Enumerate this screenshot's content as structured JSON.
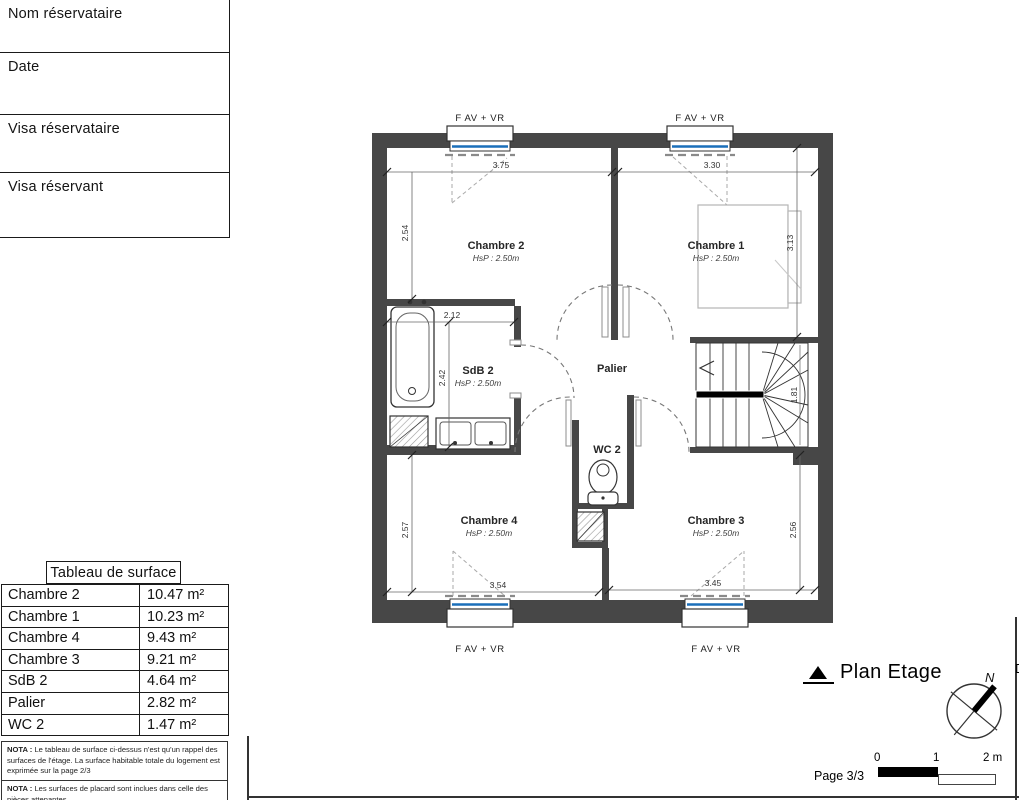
{
  "form": {
    "fields": [
      {
        "label": "Nom réservataire"
      },
      {
        "label": "Date"
      },
      {
        "label": "Visa réservataire"
      },
      {
        "label": "Visa réservant"
      }
    ]
  },
  "surface_table": {
    "title": "Tableau de surface",
    "rows": [
      {
        "room": "Chambre 2",
        "area": "10.47 m²"
      },
      {
        "room": "Chambre 1",
        "area": "10.23 m²"
      },
      {
        "room": "Chambre 4",
        "area": "9.43 m²"
      },
      {
        "room": "Chambre 3",
        "area": "9.21 m²"
      },
      {
        "room": "SdB 2",
        "area": "4.64 m²"
      },
      {
        "room": "Palier",
        "area": "2.82 m²"
      },
      {
        "room": "WC 2",
        "area": "1.47 m²"
      }
    ]
  },
  "notes": [
    {
      "label": "NOTA :",
      "text": "Le tableau de surface ci-dessus n'est qu'un rappel des surfaces de l'étage. La surface habitable totale du logement est exprimée sur la page 2/3"
    },
    {
      "label": "NOTA :",
      "text": "Les surfaces de placard sont inclues dans celle des pièces attenantes"
    }
  ],
  "plan": {
    "window_label": "F AV + VR",
    "rooms": {
      "chambre2": {
        "name": "Chambre 2",
        "hsp": "HsP : 2.50m"
      },
      "chambre1": {
        "name": "Chambre 1",
        "hsp": "HsP : 2.50m"
      },
      "sdb2": {
        "name": "SdB 2",
        "hsp": "HsP : 2.50m"
      },
      "palier": {
        "name": "Palier"
      },
      "wc2": {
        "name": "WC 2"
      },
      "chambre4": {
        "name": "Chambre 4",
        "hsp": "HsP : 2.50m"
      },
      "chambre3": {
        "name": "Chambre 3",
        "hsp": "HsP : 2.50m"
      }
    },
    "dimensions": {
      "ch2_width": "3.75",
      "ch1_width": "3.30",
      "ch2_height": "2.54",
      "ch1_height": "3.13",
      "sdb_width": "2.12",
      "sdb_height": "2.42",
      "stairs_width": "1.81",
      "ch4_height": "2.57",
      "ch4_width": "3.54",
      "ch3_width": "3.45",
      "ch3_height": "2.56"
    }
  },
  "legend": {
    "title": "Plan Etage",
    "page": "Page 3/3",
    "scale_ticks": [
      "0",
      "1",
      "2 m"
    ],
    "north": "N",
    "edge_text": "D"
  },
  "colors": {
    "wall": "#474747",
    "window_blue": "#1a6fba"
  }
}
